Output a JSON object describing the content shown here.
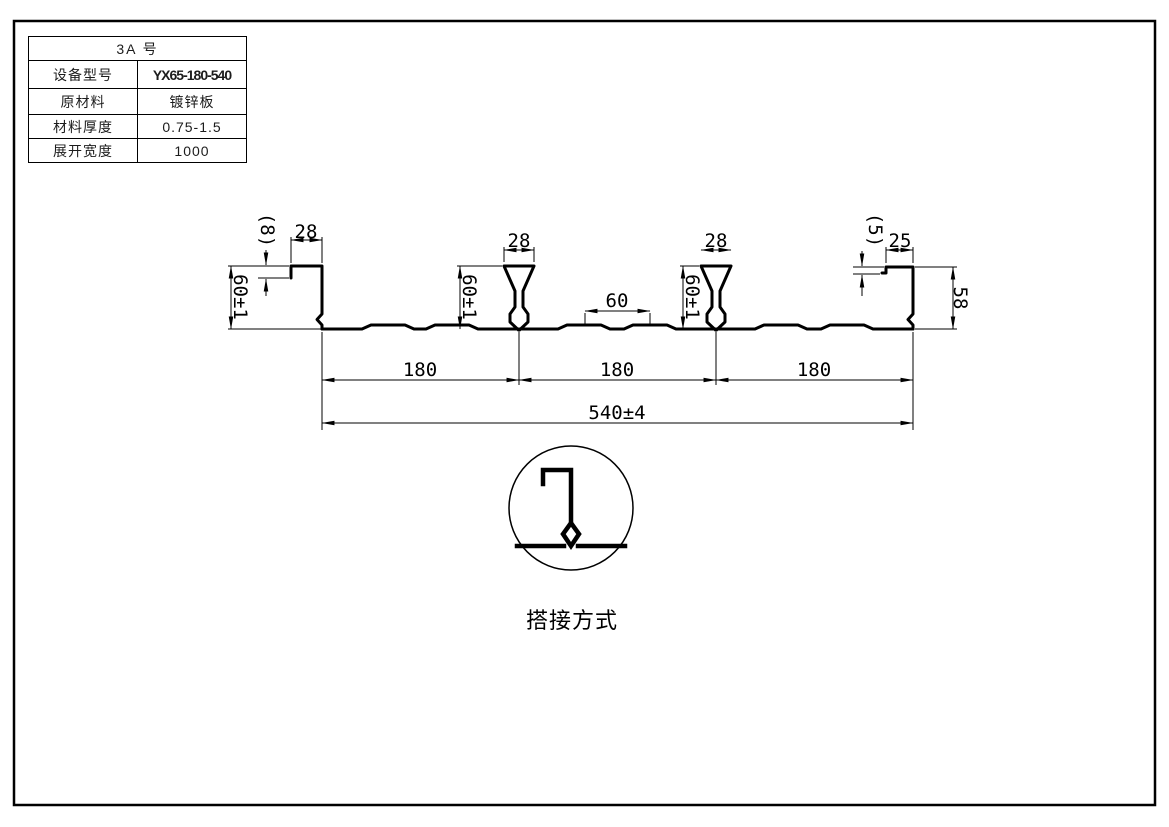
{
  "table": {
    "title": "3A  号",
    "rows": [
      {
        "label": "设备型号",
        "value": "YX65-180-540"
      },
      {
        "label": "原材料",
        "value": "镀锌板"
      },
      {
        "label": "材料厚度",
        "value": "0.75-1.5"
      },
      {
        "label": "展开宽度",
        "value": "1000"
      }
    ]
  },
  "drawing": {
    "dims": {
      "left_lip_depth": "(8)",
      "left_crest_width": "28",
      "left_height": "60±1",
      "rib1_width": "28",
      "rib1_height": "60±1",
      "mid_stiffener_spacing": "60",
      "rib2_width": "28",
      "rib2_height": "60±1",
      "right_lip_depth": "(5)",
      "right_crest_width": "25",
      "right_height": "58",
      "pitch_1": "180",
      "pitch_2": "180",
      "pitch_3": "180",
      "overall_width": "540±4"
    },
    "detail_caption": "搭接方式"
  },
  "colors": {
    "line": "#000000",
    "paper": "#ffffff"
  }
}
